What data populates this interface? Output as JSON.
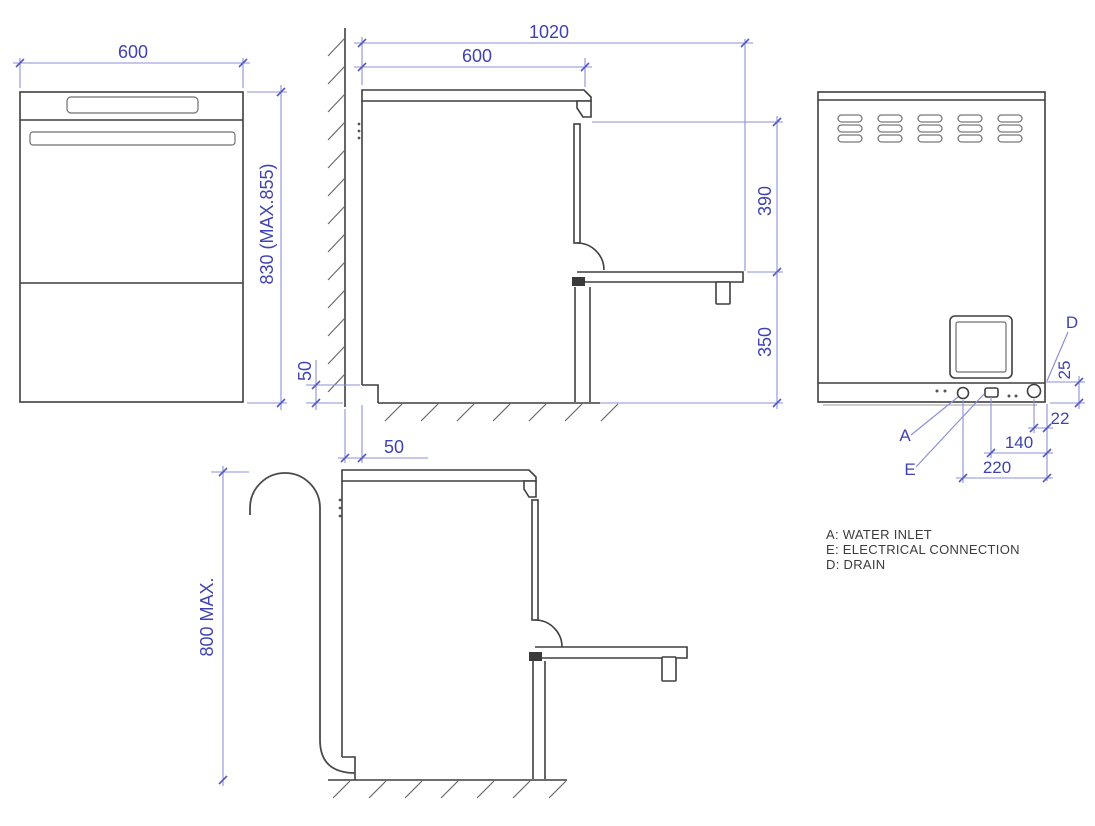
{
  "drawing": {
    "front_view": {
      "width": "600",
      "height": "830 (MAX.855)"
    },
    "side_view": {
      "depth_door_open": "1020",
      "depth": "600",
      "door_open_drop": "390",
      "door_height_from_floor": "350",
      "rear_recess_height": "50",
      "wall_clearance": "50"
    },
    "hose_view": {
      "drain_max_height": "800 MAX."
    },
    "rear_view": {
      "drain_vertical_offset": "25",
      "drain_horizontal_offset": "22",
      "electrical_offset": "140",
      "water_inlet_offset": "220",
      "water_inlet_label": "A",
      "electrical_label": "E",
      "drain_label": "D"
    },
    "legend": [
      {
        "label": "A: WATER INLET"
      },
      {
        "label": "E: ELECTRICAL CONNECTION"
      },
      {
        "label": "D: DRAIN"
      }
    ],
    "colors": {
      "dimension_text": "#3f43b0",
      "dimension_line": "#8b90d8",
      "outline": "#3f3f3f"
    }
  }
}
